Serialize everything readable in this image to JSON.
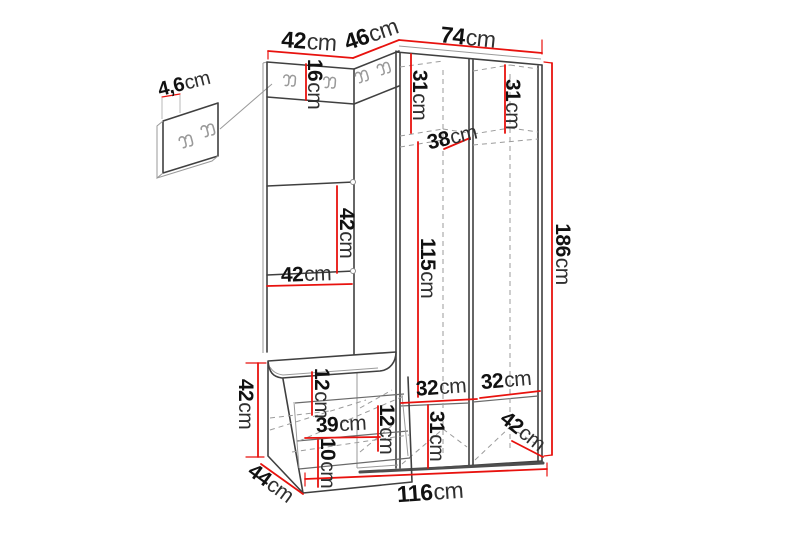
{
  "diagram": {
    "subject": "hallway-furniture-set-dimension-drawing",
    "unit": "cm",
    "colors": {
      "dimension_line": "#e8120e",
      "outline": "#404040",
      "hidden_line": "#9b9b9b",
      "background": "#ffffff",
      "text": "#121212"
    }
  },
  "dims": {
    "panel_width_top": {
      "v": "42",
      "u": "cm"
    },
    "corner_width_top": {
      "v": "46",
      "u": "cm"
    },
    "wardrobe_width_top": {
      "v": "74",
      "u": "cm"
    },
    "hook_strip_height": {
      "v": "16",
      "u": "cm"
    },
    "wall_panel_depth": {
      "v": "4,6",
      "u": "cm"
    },
    "top_left_section_height": {
      "v": "31",
      "u": "cm"
    },
    "top_right_section_height": {
      "v": "31",
      "u": "cm"
    },
    "shelf_depth": {
      "v": "38",
      "u": "cm"
    },
    "panel_section_height": {
      "v": "42",
      "u": "cm"
    },
    "panel_section_width": {
      "v": "42",
      "u": "cm"
    },
    "hanging_space_height": {
      "v": "115",
      "u": "cm"
    },
    "total_height": {
      "v": "186",
      "u": "cm"
    },
    "bottom_shelf_left_width": {
      "v": "32",
      "u": "cm"
    },
    "bottom_shelf_right_width": {
      "v": "32",
      "u": "cm"
    },
    "bottom_section_height": {
      "v": "31",
      "u": "cm"
    },
    "wardrobe_depth": {
      "v": "42",
      "u": "cm"
    },
    "total_width": {
      "v": "116",
      "u": "cm"
    },
    "bench_depth": {
      "v": "44",
      "u": "cm"
    },
    "bench_height": {
      "v": "42",
      "u": "cm"
    },
    "bench_top_section_height": {
      "v": "12",
      "u": "cm"
    },
    "bench_opening_width": {
      "v": "39",
      "u": "cm"
    },
    "bench_opening_height": {
      "v": "12",
      "u": "cm"
    },
    "bench_base_height": {
      "v": "10",
      "u": "cm"
    }
  }
}
